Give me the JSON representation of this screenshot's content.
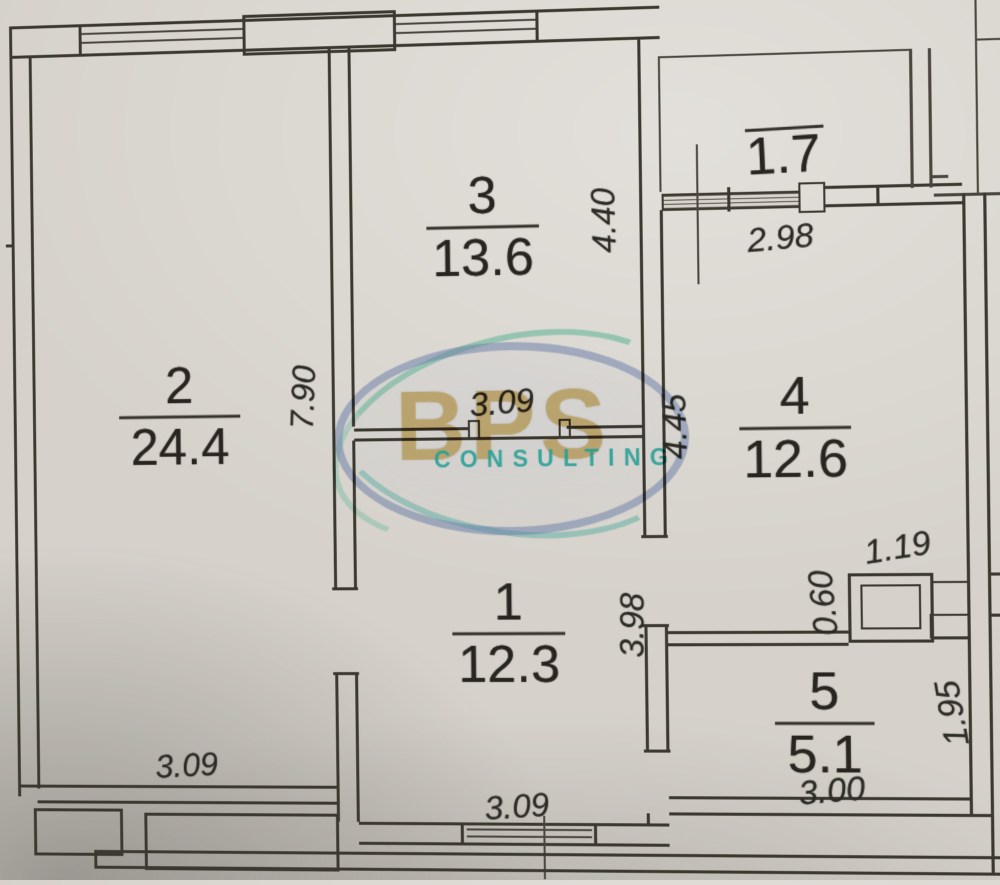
{
  "rooms": [
    {
      "id": "room-2",
      "number": "2",
      "area": "24.4"
    },
    {
      "id": "room-3",
      "number": "3",
      "area": "13.6"
    },
    {
      "id": "room-1",
      "number": "1",
      "area": "12.3"
    },
    {
      "id": "room-4",
      "number": "4",
      "area": "12.6"
    },
    {
      "id": "room-5",
      "number": "5",
      "area": "5.1"
    }
  ],
  "balcony": {
    "area": "1.7"
  },
  "dimensions": {
    "room3_room1_divider_width": "3.09",
    "room2_depth": "7.90",
    "room3_right_depth": "4.40",
    "room4_left_depth": "4.45",
    "balcony_room4_width": "2.98",
    "room1_right_depth": "3.98",
    "shaft_width": "1.19",
    "shaft_depth": "0.60",
    "room5_right_depth": "1.95",
    "room5_bottom_width": "3.00",
    "room2_bottom_width": "3.09",
    "room1_bottom_width": "3.09",
    "right_edge_partial": "1.00"
  },
  "watermark": {
    "abbr": "BPS",
    "name": "CONSULTING"
  },
  "colors": {
    "paper": "#d6d2cb",
    "wall": "#3b382f",
    "watermark_ring": "#687ca8",
    "watermark_gold": "#ba943a",
    "watermark_teal": "#2aa096"
  }
}
